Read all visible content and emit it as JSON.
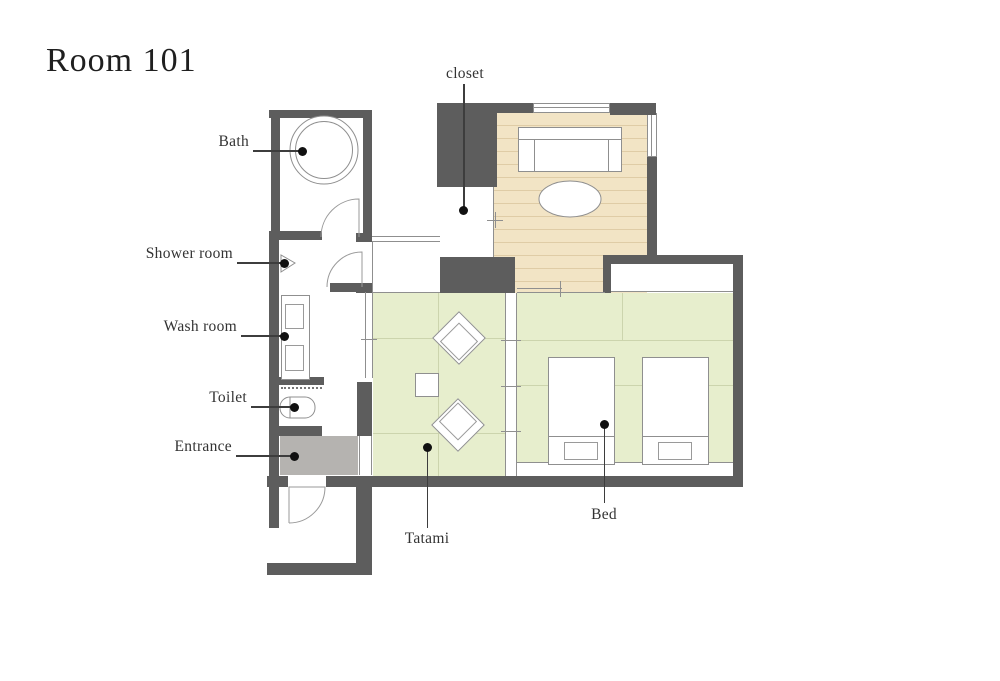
{
  "title": "Room 101",
  "labels": {
    "closet": "closet",
    "bath": "Bath",
    "shower_room": "Shower room",
    "wash_room": "Wash room",
    "toilet": "Toilet",
    "entrance": "Entrance",
    "tatami": "Tatami",
    "bed": "Bed"
  },
  "colors": {
    "wall": "#5d5d5d",
    "wood_floor": "#f2e4c5",
    "wood_line": "#dfcca6",
    "tatami_floor": "#e7eecd",
    "tatami_line": "#ccd4ad",
    "entrance_floor": "#b5b3b0",
    "outline": "#8f8f8f",
    "leader": "#3d3d3d",
    "label": "#333333",
    "title": "#1f1f1f"
  }
}
